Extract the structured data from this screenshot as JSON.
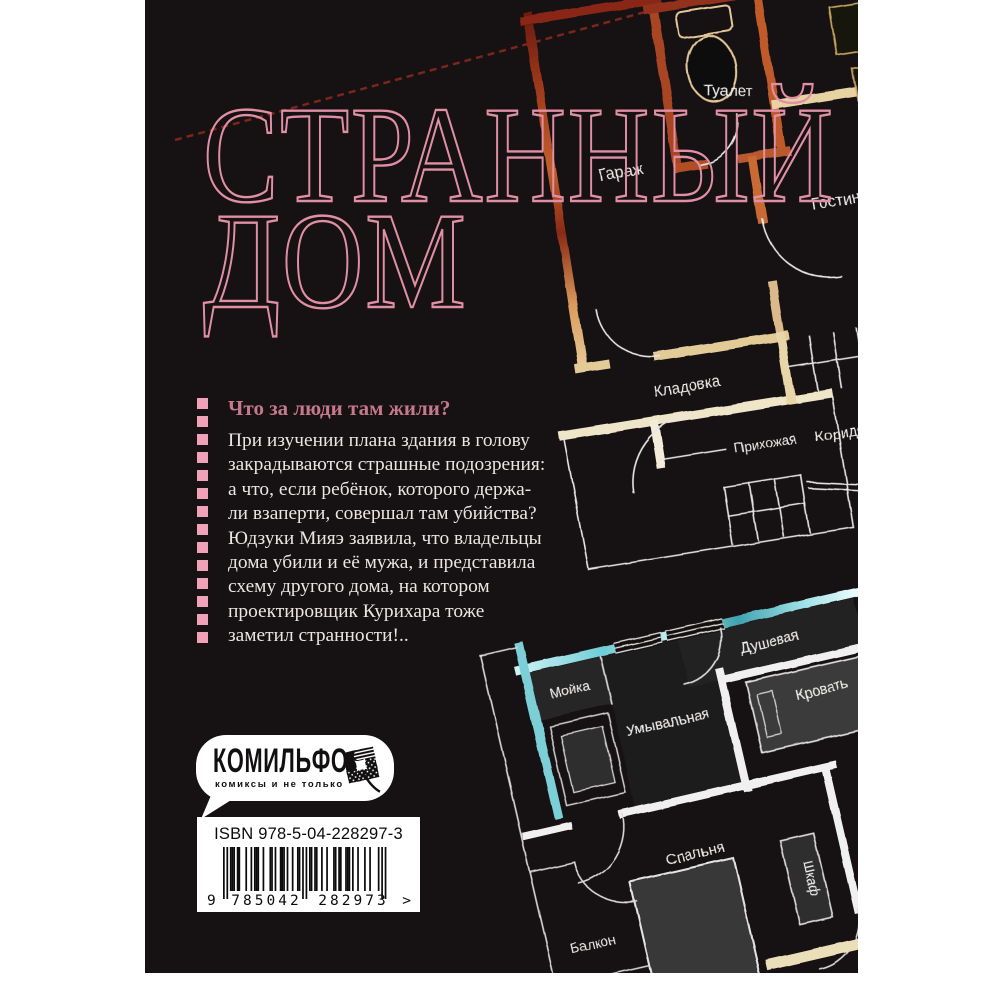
{
  "cover": {
    "title": {
      "line1": "СТРАННЫЙ",
      "line2": "ДОМ"
    },
    "annotation": {
      "heading": "Что за люди там жили?",
      "lines": [
        "При изучении плана здания в голову",
        "закрадываются страшные подозрения:",
        "а что, если ребёнок, которого держа-",
        "ли взаперти, совершал там убийства?",
        "Юдзуки Мияэ заявила, что владельцы",
        "дома убили и её мужа, и представила",
        "схему другого дома, на котором",
        "проектировщик Курихара тоже",
        "заметил странности!.."
      ]
    },
    "publisher": {
      "name": "КОМИЛЬФО",
      "tagline": "комиксы и не только"
    },
    "isbn": {
      "label": "ISBN 978-5-04-228297-3",
      "ean": "9785042282973",
      "digit_groups": [
        "9",
        "785042",
        "282973"
      ],
      "arrow": ">"
    },
    "plans": {
      "top": {
        "rooms": {
          "toilet": "Туалет",
          "garage": "Гараж",
          "living": "Гостин",
          "storage": "Кладовка",
          "hall": "Прихожая",
          "corridor": "Коридор"
        }
      },
      "bottom": {
        "rooms": {
          "shower": "Душевая",
          "sink": "Мойка",
          "wash": "Умывальная",
          "bed": "Кровать",
          "bedroom": "Спальня",
          "wardrobe": "Шкаф",
          "balcony": "Балкон"
        }
      }
    },
    "colors": {
      "cover_bg": "#161112",
      "title_outline": "#e18fa5",
      "heading": "#c5788e",
      "dash": "#f0a3b8",
      "body_text": "#eae6e4",
      "rust": "#a8431f",
      "cream": "#e7d3a2",
      "teal": "#7ccfd6"
    }
  }
}
